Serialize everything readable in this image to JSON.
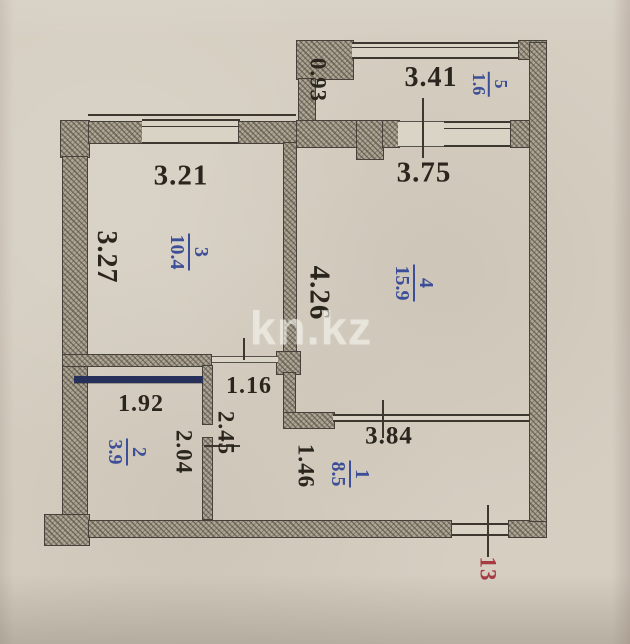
{
  "watermark": "kn.kz",
  "entry_number": "13",
  "colors": {
    "paper": "#d5cec1",
    "wall_fill": "#aea695",
    "line_ink": "#3c372f",
    "room_label_blue": "#3c4e97",
    "entry_red": "#a63a44",
    "dimension_ink": "#2a261d",
    "fixture_navy": "#27305a"
  },
  "rooms": [
    {
      "id": "1",
      "area": "8.5"
    },
    {
      "id": "2",
      "area": "3.9"
    },
    {
      "id": "3",
      "area": "10.4"
    },
    {
      "id": "4",
      "area": "15.9"
    },
    {
      "id": "5",
      "area": "1.6"
    }
  ],
  "dims": {
    "d341": "3.41",
    "d093": "0.93",
    "d321": "3.21",
    "d375": "3.75",
    "d327": "3.27",
    "d426": "4.26",
    "d116": "1.16",
    "d192": "1.92",
    "d204": "2.04",
    "d245": "2.45",
    "d146": "1.46",
    "d384": "3.84"
  }
}
